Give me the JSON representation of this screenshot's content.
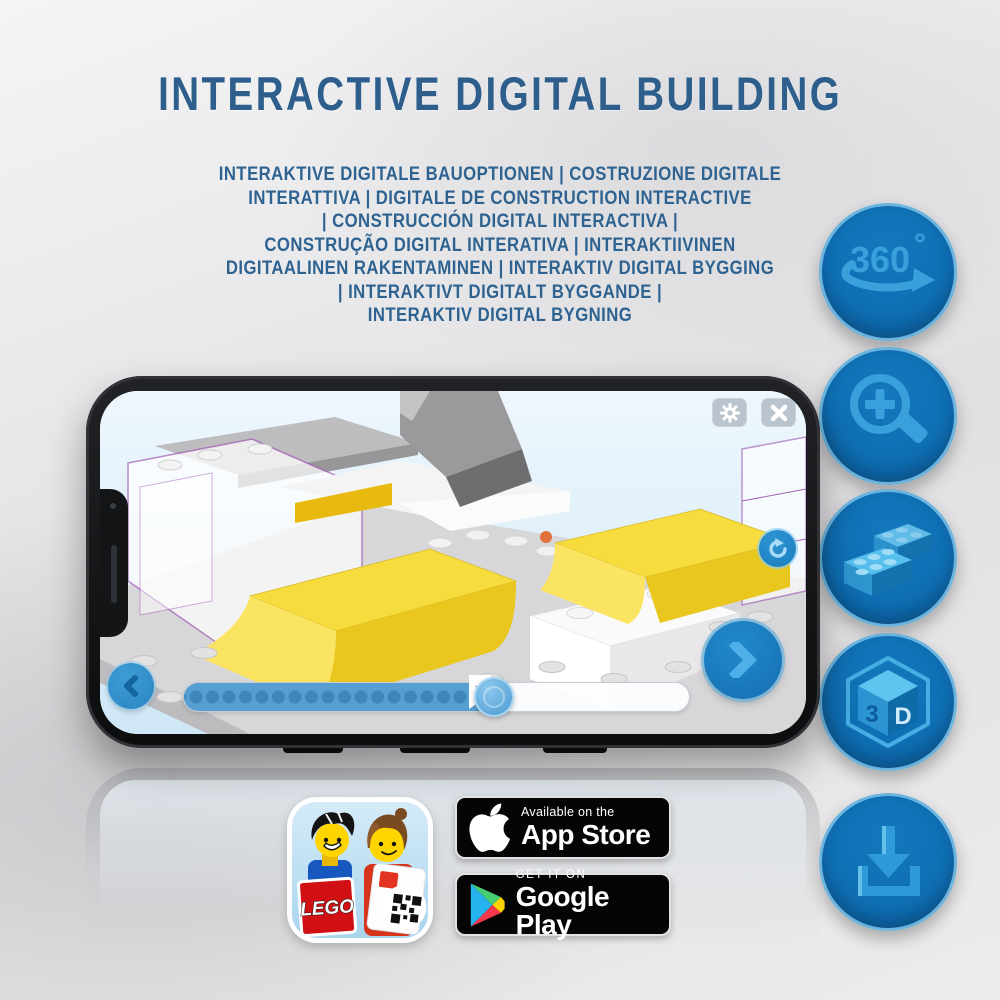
{
  "title": "INTERACTIVE DIGITAL BUILDING",
  "subtitle_lines": [
    "INTERAKTIVE DIGITALE BAUOPTIONEN | COSTRUZIONE DIGITALE",
    "INTERATTIVA | DIGITALE DE CONSTRUCTION INTERACTIVE",
    "| CONSTRUCCIÓN DIGITAL INTERACTIVA |",
    "CONSTRUÇÃO DIGITAL INTERATIVA | INTERAKTIIVINEN",
    "DIGITAALINEN RAKENTAMINEN | INTERAKTIV DIGITAL BYGGING",
    "| INTERAKTIVT DIGITALT BYGGANDE |",
    "INTERAKTIV DIGITAL BYGNING"
  ],
  "feature_icons": {
    "rotation": {
      "label": "360",
      "sup": "°"
    },
    "cube": {
      "label_left": "3",
      "label_right": "D"
    }
  },
  "phone_app": {
    "progress_percent": 61,
    "bookmark_percent": 42
  },
  "badges": {
    "app_store": {
      "line1": "Available on the",
      "line2": "App Store"
    },
    "google_play": {
      "line1": "GET IT ON",
      "line2": "Google Play"
    }
  },
  "app_icon": {
    "logo_text": "LEGO"
  },
  "colors": {
    "title_blue": "#2d5e8c",
    "circle_blue": "#0f6fb4",
    "icon_light_blue": "#3aa0dc",
    "lego_yellow": "#f7dc3d",
    "badge_black": "#050505"
  }
}
